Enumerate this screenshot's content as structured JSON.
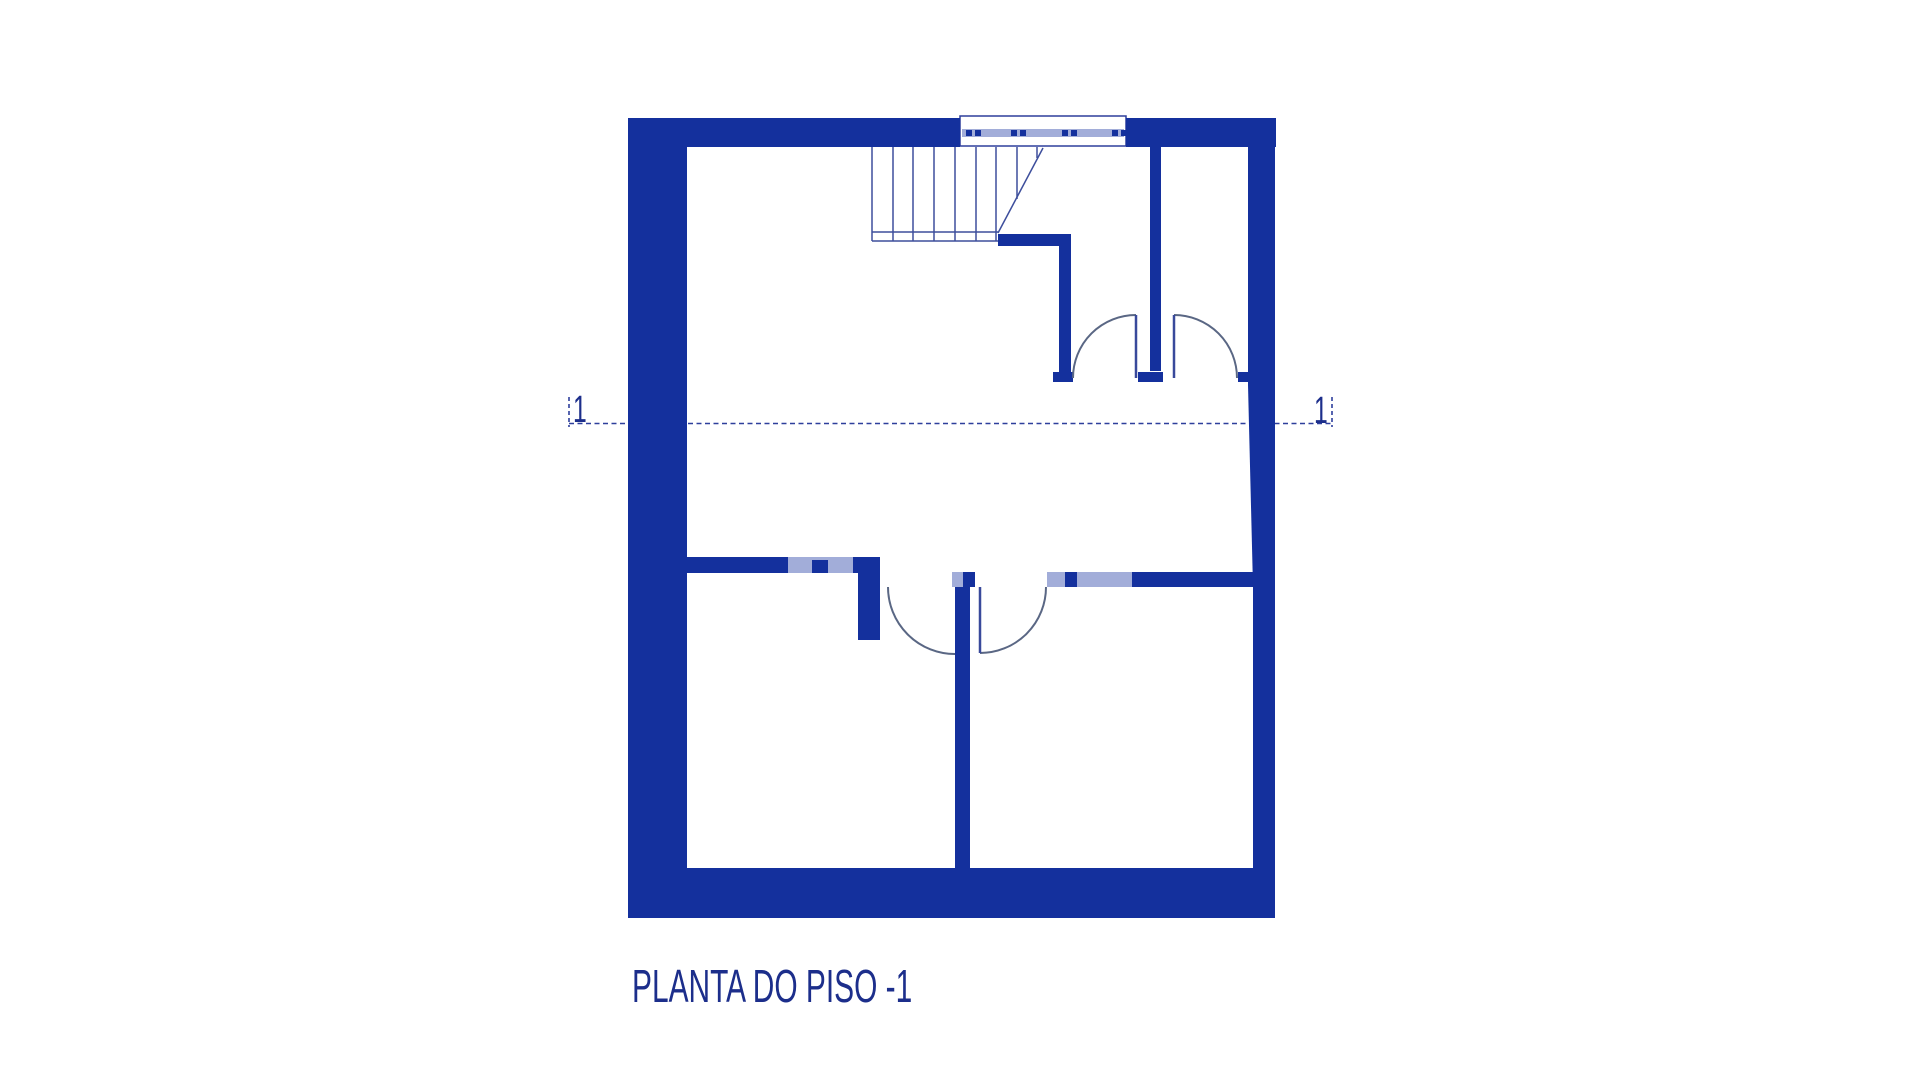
{
  "page": {
    "background": "#ffffff"
  },
  "title": {
    "label": "PLANTA DO PISO -1"
  },
  "section_markers": {
    "left_label": "1",
    "right_label": "1"
  },
  "colors": {
    "wall": "#14309d",
    "window_light": "#a2add9",
    "window_border": "#2e3f9c",
    "stair_line": "#3d4e9c",
    "arc_line": "#5a6784",
    "leaf_line": "#39499b",
    "section_line": "#2e3f9c",
    "text": "#1c2e8b",
    "background": "#ffffff"
  },
  "floor_plan": {
    "canvas": {
      "width": 1920,
      "height": 1080
    },
    "section_line": {
      "y": 423.5,
      "x1": 569,
      "x2": 1332,
      "tick_top": 397,
      "tick_bottom": 427,
      "dash": "5 3.5",
      "width": 1.6
    },
    "wall_rects": [
      [
        628,
        118,
        59,
        800
      ],
      [
        628,
        118,
        332,
        29
      ],
      [
        1126,
        118,
        150,
        29
      ],
      [
        1248,
        118,
        27,
        267
      ],
      [
        1253,
        587,
        22,
        281
      ],
      [
        628,
        868,
        647,
        50
      ],
      [
        682,
        557,
        106,
        16
      ],
      [
        812,
        560,
        16,
        13
      ],
      [
        853,
        557,
        27,
        16
      ],
      [
        858,
        573,
        22,
        67
      ],
      [
        963,
        572,
        12,
        15
      ],
      [
        955,
        587,
        15,
        281
      ],
      [
        1065,
        572,
        12,
        15
      ],
      [
        1132,
        572,
        122,
        15
      ],
      [
        998,
        234,
        73,
        12
      ],
      [
        1059,
        246,
        12,
        126
      ],
      [
        1053,
        372,
        20,
        10
      ],
      [
        1138,
        372,
        25,
        10
      ],
      [
        1238,
        372,
        12,
        10
      ],
      [
        1150,
        147,
        11,
        224
      ]
    ],
    "wall_polygons": [
      "1248,385 1275,385 1275,587 1253,587"
    ],
    "light_rects": [
      [
        788,
        557,
        65,
        16
      ],
      [
        952,
        572,
        11,
        15
      ],
      [
        1047,
        572,
        85,
        15
      ]
    ],
    "window_top": {
      "box": [
        960,
        116,
        166,
        30
      ],
      "band": [
        962,
        129,
        162,
        8
      ],
      "dashes": [
        [
          966,
          130,
          6,
          6
        ],
        [
          975,
          130,
          6,
          6
        ],
        [
          1011,
          130,
          6,
          6
        ],
        [
          1020,
          130,
          6,
          6
        ],
        [
          1062,
          130,
          6,
          6
        ],
        [
          1071,
          130,
          6,
          6
        ],
        [
          1112,
          130,
          6,
          6
        ],
        [
          1121,
          130,
          6,
          6
        ]
      ]
    },
    "stair": {
      "treads": [
        [
          872,
          147,
          241
        ],
        [
          893,
          147,
          241
        ],
        [
          913,
          147,
          241
        ],
        [
          934,
          147,
          241
        ],
        [
          955,
          147,
          241
        ],
        [
          976,
          147,
          241
        ],
        [
          996,
          147,
          241
        ],
        [
          1017,
          147,
          199
        ],
        [
          1037,
          147,
          158
        ]
      ],
      "base_lines": [
        [
          872,
          232,
          998
        ],
        [
          872,
          241,
          998
        ]
      ],
      "diagonal": [
        998,
        233,
        1043,
        148
      ]
    },
    "door_arcs": [
      "M 888 587 A 67 67 0 0 0 955 654",
      "M 980 653 A 66 66 0 0 0 1046 587",
      "M 1073 378 A 63 63 0 0 1 1136 315",
      "M 1174 315 A 63 63 0 0 1 1237 378"
    ],
    "door_leaves": [
      [
        980,
        587,
        653
      ],
      [
        1136,
        315,
        378
      ],
      [
        1174,
        315,
        378
      ]
    ]
  }
}
